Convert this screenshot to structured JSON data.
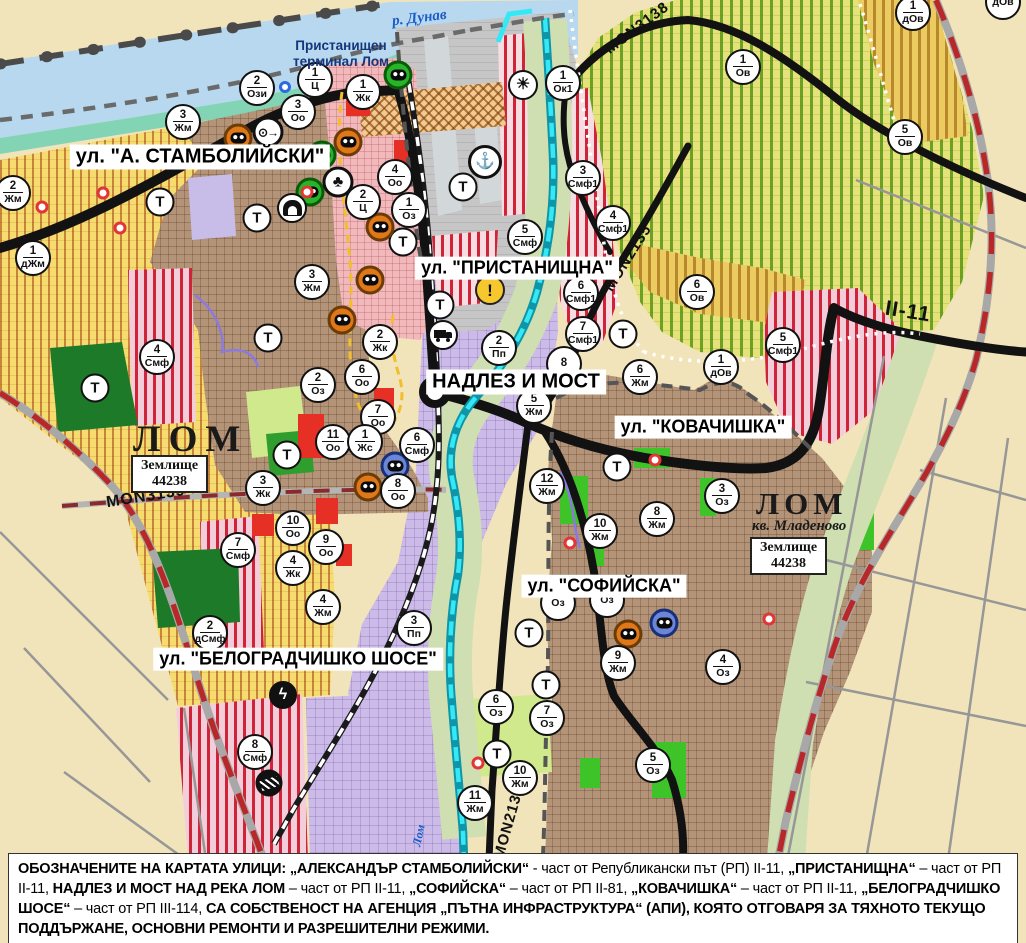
{
  "map": {
    "labels": {
      "danube": "р. Дунав",
      "port_terminal": "Пристанищен терминал Лом",
      "lom_west": "ЛОМ",
      "lom_east": "ЛОМ",
      "kv_mladenovo": "кв. Младеново",
      "zemlishte_word": "Землище",
      "zemlishte_number": "44238",
      "lom_river": "Лом",
      "t_marker": "Т"
    },
    "street_labels": [
      {
        "t": "ул. \"А. СТАМБОЛИЙСКИ\"",
        "x": 200,
        "y": 157,
        "fs": 20
      },
      {
        "t": "ул. \"ПРИСТАНИЩНА\"",
        "x": 517,
        "y": 268,
        "fs": 18
      },
      {
        "t": "НАДЛЕЗ И МОСТ",
        "x": 516,
        "y": 382,
        "fs": 20
      },
      {
        "t": "ул. \"КОВАЧИШКА\"",
        "x": 703,
        "y": 427,
        "fs": 18
      },
      {
        "t": "ул. \"СОФИЙСКА\"",
        "x": 604,
        "y": 586,
        "fs": 18
      },
      {
        "t": "ул. \"БЕЛОГРАДЧИШКО ШОСЕ\"",
        "x": 298,
        "y": 659,
        "fs": 18
      }
    ],
    "road_labels": [
      {
        "t": "MON3138",
        "x": 637,
        "y": 28,
        "a": -37,
        "fs": 15
      },
      {
        "t": "MON2135",
        "x": 628,
        "y": 258,
        "a": -58,
        "fs": 15
      },
      {
        "t": "II-11",
        "x": 908,
        "y": 312,
        "a": 9,
        "fs": 21
      },
      {
        "t": "MON3139",
        "x": 146,
        "y": 497,
        "a": -9,
        "fs": 16
      },
      {
        "t": "MON2136",
        "x": 509,
        "y": 822,
        "a": -74,
        "fs": 15
      }
    ],
    "markers": [
      {
        "n": "2",
        "c": "Ози",
        "x": 257,
        "y": 88
      },
      {
        "n": "1",
        "c": "Ц",
        "x": 315,
        "y": 80
      },
      {
        "n": "3",
        "c": "Оо",
        "x": 298,
        "y": 112
      },
      {
        "n": "1",
        "c": "Жк",
        "x": 363,
        "y": 92
      },
      {
        "n": "3",
        "c": "Жм",
        "x": 183,
        "y": 122
      },
      {
        "n": "2",
        "c": "Жм",
        "x": 13,
        "y": 193
      },
      {
        "n": "4",
        "c": "Оо",
        "x": 395,
        "y": 177
      },
      {
        "n": "2",
        "c": "Ц",
        "x": 363,
        "y": 202
      },
      {
        "n": "1",
        "c": "Оз",
        "x": 409,
        "y": 210
      },
      {
        "n": "1",
        "c": "дЖм",
        "x": 33,
        "y": 258
      },
      {
        "n": "3",
        "c": "Жм",
        "x": 312,
        "y": 282
      },
      {
        "n": "4",
        "c": "Смф",
        "x": 157,
        "y": 357
      },
      {
        "n": "2",
        "c": "Жк",
        "x": 380,
        "y": 342
      },
      {
        "n": "2",
        "c": "Оз",
        "x": 318,
        "y": 385
      },
      {
        "n": "6",
        "c": "Оо",
        "x": 362,
        "y": 377
      },
      {
        "n": "7",
        "c": "Оо",
        "x": 378,
        "y": 417
      },
      {
        "n": "11",
        "c": "Оо",
        "x": 333,
        "y": 442
      },
      {
        "n": "1",
        "c": "Жс",
        "x": 365,
        "y": 442
      },
      {
        "n": "6",
        "c": "Смф",
        "x": 417,
        "y": 445
      },
      {
        "n": "8",
        "c": "Оо",
        "x": 398,
        "y": 491
      },
      {
        "n": "3",
        "c": "Жк",
        "x": 263,
        "y": 488
      },
      {
        "n": "10",
        "c": "Оо",
        "x": 293,
        "y": 528
      },
      {
        "n": "9",
        "c": "Оо",
        "x": 326,
        "y": 547
      },
      {
        "n": "4",
        "c": "Жк",
        "x": 293,
        "y": 568
      },
      {
        "n": "4",
        "c": "Жм",
        "x": 323,
        "y": 607
      },
      {
        "n": "7",
        "c": "Смф",
        "x": 238,
        "y": 550
      },
      {
        "n": "2",
        "c": "дСмф",
        "x": 210,
        "y": 633
      },
      {
        "n": "3",
        "c": "Пп",
        "x": 414,
        "y": 628
      },
      {
        "n": "8",
        "c": "Смф",
        "x": 255,
        "y": 752
      },
      {
        "n": "2",
        "c": "Пп",
        "x": 499,
        "y": 348
      },
      {
        "n": "5",
        "c": "Смф",
        "x": 525,
        "y": 237
      },
      {
        "n": "5",
        "c": "Жм",
        "x": 534,
        "y": 406
      },
      {
        "n": "8",
        "c": "",
        "x": 564,
        "y": 364
      },
      {
        "n": "6",
        "c": "Смф1",
        "x": 581,
        "y": 293
      },
      {
        "n": "7",
        "c": "Смф1",
        "x": 583,
        "y": 334
      },
      {
        "n": "3",
        "c": "Смф1",
        "x": 583,
        "y": 178
      },
      {
        "n": "4",
        "c": "Смф1",
        "x": 613,
        "y": 223
      },
      {
        "n": "1",
        "c": "Ок1",
        "x": 563,
        "y": 83
      },
      {
        "n": "1",
        "c": "Ов",
        "x": 743,
        "y": 67
      },
      {
        "n": "5",
        "c": "Ов",
        "x": 905,
        "y": 137
      },
      {
        "n": "1",
        "c": "дОв",
        "x": 913,
        "y": 13
      },
      {
        "n": "",
        "c": "дОв",
        "x": 1003,
        "y": 2
      },
      {
        "n": "6",
        "c": "Ов",
        "x": 697,
        "y": 292
      },
      {
        "n": "1",
        "c": "дОв",
        "x": 721,
        "y": 367
      },
      {
        "n": "5",
        "c": "Смф1",
        "x": 783,
        "y": 345
      },
      {
        "n": "6",
        "c": "Жм",
        "x": 640,
        "y": 377
      },
      {
        "n": "12",
        "c": "Жм",
        "x": 547,
        "y": 486
      },
      {
        "n": "10",
        "c": "Жм",
        "x": 600,
        "y": 531
      },
      {
        "n": "8",
        "c": "Жм",
        "x": 657,
        "y": 519
      },
      {
        "n": "3",
        "c": "Оз",
        "x": 722,
        "y": 496
      },
      {
        "n": "",
        "c": "Оз",
        "x": 558,
        "y": 603
      },
      {
        "n": "",
        "c": "Оз",
        "x": 607,
        "y": 600
      },
      {
        "n": "9",
        "c": "Жм",
        "x": 618,
        "y": 663
      },
      {
        "n": "4",
        "c": "Оз",
        "x": 723,
        "y": 667
      },
      {
        "n": "6",
        "c": "Оз",
        "x": 496,
        "y": 707
      },
      {
        "n": "7",
        "c": "Оз",
        "x": 547,
        "y": 718
      },
      {
        "n": "5",
        "c": "Оз",
        "x": 653,
        "y": 765
      },
      {
        "n": "10",
        "c": "Жм",
        "x": 520,
        "y": 778
      },
      {
        "n": "11",
        "c": "Жм",
        "x": 475,
        "y": 803
      }
    ],
    "t_markers": [
      {
        "x": 160,
        "y": 202
      },
      {
        "x": 257,
        "y": 218
      },
      {
        "x": 463,
        "y": 187
      },
      {
        "x": 403,
        "y": 242
      },
      {
        "x": 440,
        "y": 305
      },
      {
        "x": 268,
        "y": 338
      },
      {
        "x": 95,
        "y": 388
      },
      {
        "x": 287,
        "y": 455
      },
      {
        "x": 623,
        "y": 334
      },
      {
        "x": 617,
        "y": 467
      },
      {
        "x": 529,
        "y": 633
      },
      {
        "x": 546,
        "y": 685
      },
      {
        "x": 497,
        "y": 754
      }
    ],
    "icons": [
      {
        "t": "mask",
        "c": "o",
        "x": 238,
        "y": 138
      },
      {
        "t": "mask",
        "c": "o",
        "x": 348,
        "y": 142
      },
      {
        "t": "mask",
        "c": "o",
        "x": 380,
        "y": 227
      },
      {
        "t": "mask",
        "c": "o",
        "x": 370,
        "y": 280
      },
      {
        "t": "mask",
        "c": "o",
        "x": 342,
        "y": 320
      },
      {
        "t": "mask",
        "c": "o",
        "x": 368,
        "y": 487
      },
      {
        "t": "mask",
        "c": "o",
        "x": 628,
        "y": 634
      },
      {
        "t": "mask",
        "c": "g",
        "x": 398,
        "y": 75
      },
      {
        "t": "mask",
        "c": "g",
        "x": 322,
        "y": 155
      },
      {
        "t": "mask",
        "c": "g",
        "x": 310,
        "y": 192
      },
      {
        "t": "mask",
        "c": "b",
        "x": 395,
        "y": 466
      },
      {
        "t": "mask",
        "c": "b",
        "x": 664,
        "y": 623
      },
      {
        "t": "anchor",
        "x": 485,
        "y": 162
      },
      {
        "t": "sun",
        "x": 523,
        "y": 85
      },
      {
        "t": "source",
        "x": 268,
        "y": 132
      },
      {
        "t": "club",
        "x": 338,
        "y": 182
      },
      {
        "t": "cave",
        "x": 292,
        "y": 208
      },
      {
        "t": "truck",
        "x": 443,
        "y": 335
      },
      {
        "t": "warning",
        "x": 490,
        "y": 290
      },
      {
        "t": "lightning",
        "x": 283,
        "y": 695
      },
      {
        "t": "railcross",
        "x": 269,
        "y": 783
      },
      {
        "t": "bluering",
        "x": 285,
        "y": 87
      },
      {
        "t": "reddot",
        "x": 42,
        "y": 207
      },
      {
        "t": "reddot",
        "x": 103,
        "y": 193
      },
      {
        "t": "reddot",
        "x": 120,
        "y": 228
      },
      {
        "t": "reddot",
        "x": 307,
        "y": 192
      },
      {
        "t": "reddot",
        "x": 655,
        "y": 460
      },
      {
        "t": "reddot",
        "x": 570,
        "y": 543
      },
      {
        "t": "reddot",
        "x": 478,
        "y": 763
      },
      {
        "t": "reddot",
        "x": 769,
        "y": 619
      }
    ],
    "colors": {
      "water": "#b7d8ee",
      "cadastre_beige": "#f2e4ba",
      "urban_brown": "#b39478",
      "center_pink": "#f2b9bd",
      "industrial_purple": "#ccbae8",
      "agri_yellow": "#f6dc6e",
      "vineyard_base": "#e6e27a",
      "vineyard_stripe": "#56961e",
      "smf_red": "#cf2338",
      "park_green": "#2f9e2f",
      "bright_green": "#3ec428",
      "floodplain": "#cfdfb2",
      "port_gray": "#c6c6c6",
      "road_black": "#121212",
      "boundary_red": "#b82828",
      "river_cyan": "#35e8f5",
      "warning_yellow": "#f6c82e",
      "masks": {
        "o": [
          "#e07818",
          "#6b3c08"
        ],
        "g": [
          "#28b428",
          "#0a5a0a"
        ],
        "b": [
          "#6b86d8",
          "#18307a"
        ]
      }
    }
  },
  "footer": {
    "segments": [
      {
        "b": 1,
        "t": "ОБОЗНАЧЕНИТЕ НА КАРТАТА УЛИЦИ: „АЛЕКСАНДЪР СТАМБОЛИЙСКИ“"
      },
      {
        "b": 0,
        "t": " - част от Републикански път (РП) II-11, "
      },
      {
        "b": 1,
        "t": "„ПРИСТАНИЩНА“"
      },
      {
        "b": 0,
        "t": " – част от РП II-11, "
      },
      {
        "b": 1,
        "t": "НАДЛЕЗ И МОСТ НАД РЕКА ЛОМ"
      },
      {
        "b": 0,
        "t": " – част от РП II-11, "
      },
      {
        "b": 1,
        "t": "„СОФИЙСКА“"
      },
      {
        "b": 0,
        "t": " – част от РП II-81, "
      },
      {
        "b": 1,
        "t": "„КОВАЧИШКА“"
      },
      {
        "b": 0,
        "t": " – част от РП II-11, "
      },
      {
        "b": 1,
        "t": "„БЕЛОГРАДЧИШКО ШОСЕ“"
      },
      {
        "b": 0,
        "t": " – част от РП III-114, "
      },
      {
        "b": 1,
        "t": "СА СОБСТВЕНОСТ НА АГЕНЦИЯ „ПЪТНА ИНФРАСТРУКТУРА“ (АПИ), КОЯТО ОТГОВАРЯ ЗА ТЯХНОТО ТЕКУЩО ПОДДЪРЖАНЕ, ОСНОВНИ РЕМОНТИ И РАЗРЕШИТЕЛНИ РЕЖИМИ."
      }
    ]
  }
}
